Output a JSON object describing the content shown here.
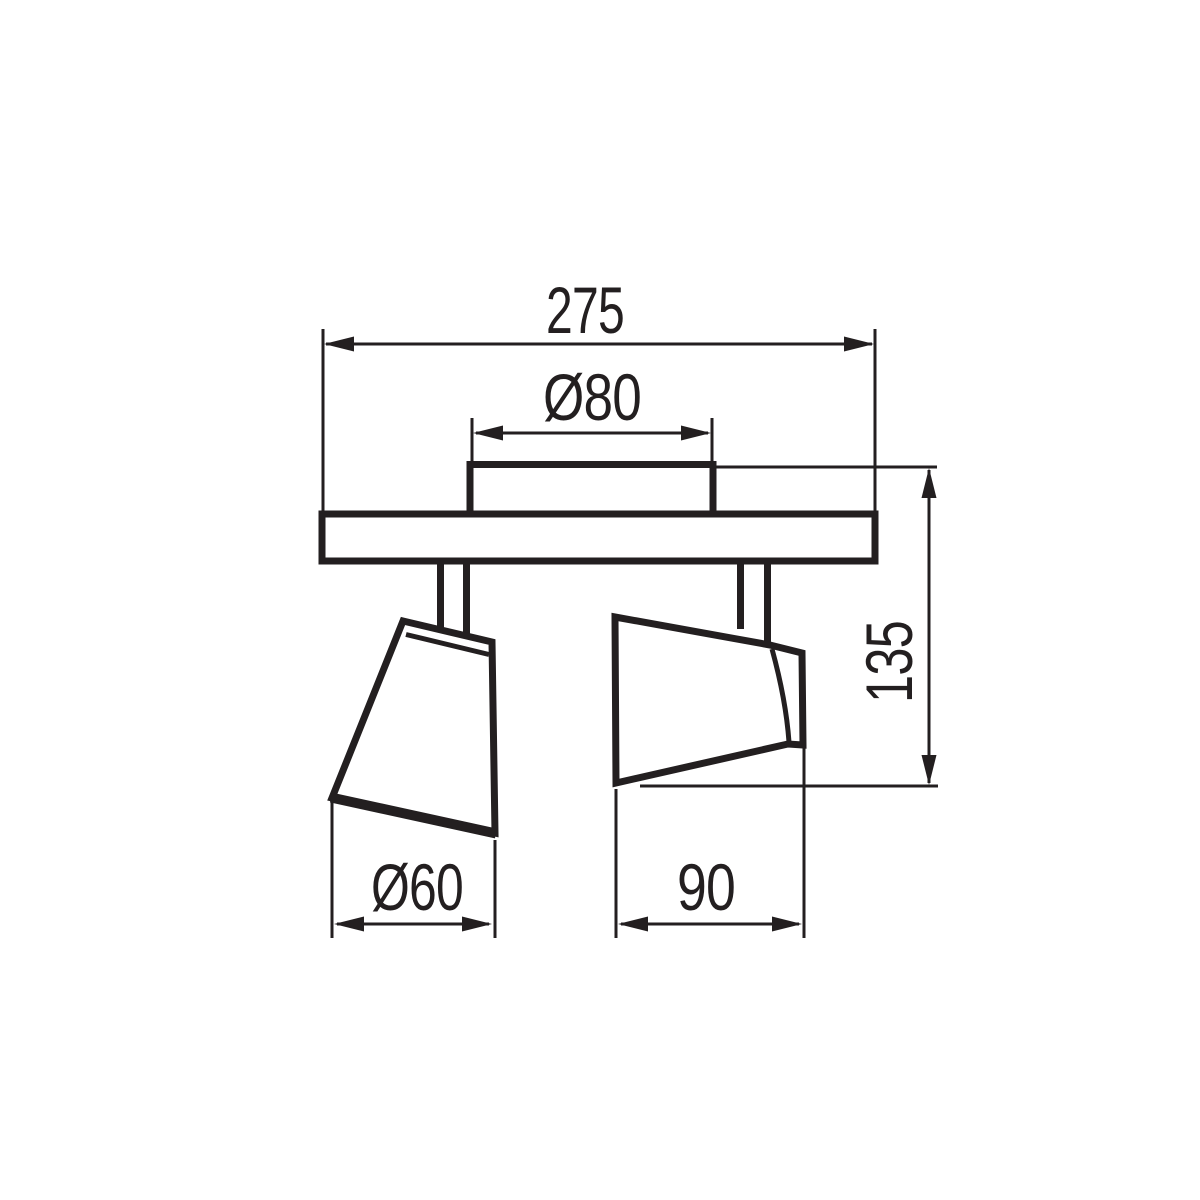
{
  "drawing": {
    "subject": "two-head ceiling spotlight fixture - dimensioned technical side view",
    "background": "#ffffff",
    "line_color": "#231f20",
    "dimensions": {
      "overall_width": "275",
      "canopy_diameter": "Ø80",
      "fixture_height": "135",
      "left_shade_diameter": "Ø60",
      "right_shade_width": "90"
    }
  }
}
